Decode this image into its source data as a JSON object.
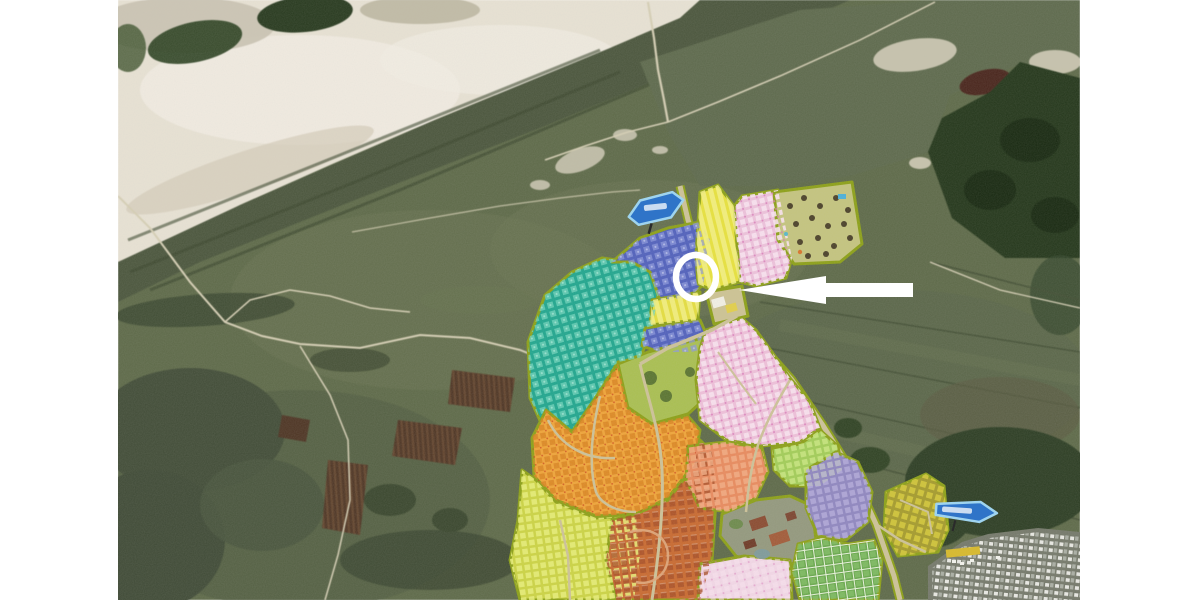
{
  "map": {
    "description": "Aerial satellite photo of a coastal dune area with a holiday-park plan overlaid in color-coded accommodation zones; a white circle and white arrow highlight the park entrance junction",
    "terrain": {
      "field": "#5d6947",
      "beach_sand": "#e8e2d3",
      "beach_sand_light": "#f2eee3",
      "tidal_flat": "#c9c2b0",
      "dune_band": "#4a553b",
      "dune_grass": "#5d694b",
      "forest": "#223619",
      "forest_shadow": "#16280f",
      "burnt_patch": "#4a241a",
      "shrub": "#414c36",
      "plowed_field": "#4e3422",
      "plowed_stripe": "#6b4a30",
      "trail": "#d6cfb4",
      "road": "#cdc298",
      "verge": "#8ca016"
    },
    "zone_colors": {
      "teal": "#1fa68e",
      "blue_upper": "#5060bc",
      "blue_lower": "#5060bc",
      "yellow_mid": "#e5de3f",
      "yellow_top": "#e8e23c",
      "pink_top": "#eec2dc",
      "recreation": "#c4c47e",
      "entrance": "#cdc393",
      "grass_mid": "#a9bf50",
      "orange": "#f0a437",
      "yellow_green": "#ccd443",
      "terracotta": "#c9692f",
      "pink_big": "#efc0da",
      "salmon": "#e98a5d",
      "facilities": "#93987d",
      "light_green": "#a2cd57",
      "purple": "#8f86c0",
      "green_se": "#68a84c",
      "pink_bottom": "#f3d7e7",
      "olive_east": "#a59b2b",
      "parking": "#74786a"
    },
    "annotations": {
      "highlight_circle": {
        "color": "#ffffff"
      },
      "pointer_arrow": {
        "color": "#ffffff",
        "direction": "left"
      },
      "sign_beach": {
        "fill": "#2f74c8",
        "border": "#9fd4ef",
        "text_color": "#ffffff"
      },
      "sign_east": {
        "fill": "#2f74c8",
        "border": "#9fd4ef",
        "text_color": "#ffffff"
      },
      "parking_label": {
        "fill": "#d8b92a"
      }
    }
  }
}
